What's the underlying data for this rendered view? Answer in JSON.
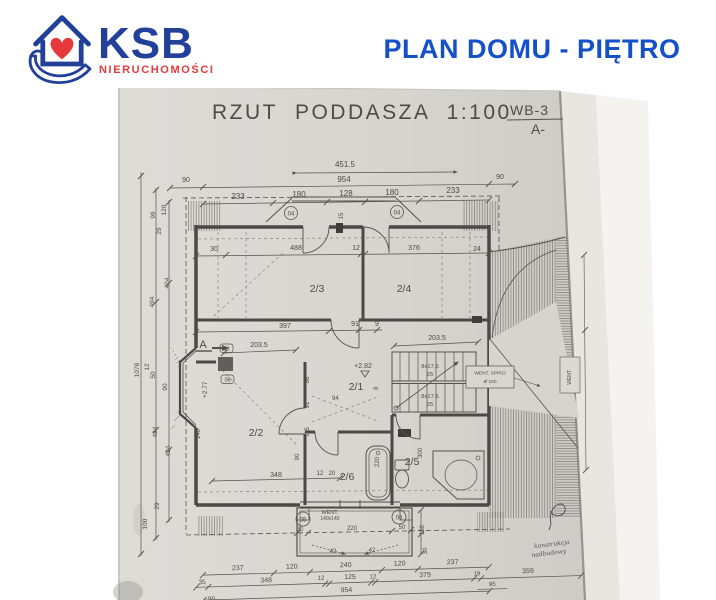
{
  "header": {
    "brand": "KSB",
    "brand_subtitle": "NIERUCHOMOŚCI",
    "page_title": "PLAN DOMU - PIĘTRO",
    "colors": {
      "brand_blue": "#21409a",
      "brand_red": "#e6393d",
      "title_blue": "#1450c8"
    }
  },
  "drawing": {
    "title": "RZUT PODDASZA 1:100",
    "sheet_code_line1": "WB-3",
    "sheet_code_line2": "A-",
    "paper_color": "#d8d6d1",
    "line_color": "#54524c",
    "rooms": {
      "hall": "2/1",
      "room_a": "2/2",
      "room_b": "2/3",
      "room_c": "2/4",
      "bath_a": "2/5",
      "bath_b": "2/6"
    },
    "levels": {
      "hall_level": "+2.82",
      "bay_level": "+2.77"
    },
    "stairs": {
      "riser_label": "8x17.6",
      "tread_label": "25"
    },
    "markers": {
      "dormer_left": "04",
      "dormer_right": "04",
      "bay_top": "08",
      "bay_bottom": "08",
      "balcony_left": "05",
      "balcony_right": "06",
      "section": "A"
    },
    "annotations": {
      "balcony_vent_1": "WENT.",
      "balcony_vent_2": "140x140",
      "roof_note_1": "WENT. SPIRO",
      "roof_note_2": "Ø 150",
      "wall_note": "WENT.",
      "hand_note_1": "konstrukcja",
      "hand_note_2": "nadbudowy"
    },
    "dims": {
      "top": [
        "451.5",
        "954",
        "90",
        "90",
        "233",
        "180",
        "128",
        "180",
        "233",
        "15"
      ],
      "rooms_top": [
        "30",
        "488",
        "12",
        "376",
        "24"
      ],
      "rooms_mid": [
        "397",
        "91",
        "9"
      ],
      "stair_depth": [
        "203.5",
        "203.5"
      ],
      "left": [
        "1078",
        "120",
        "99",
        "29",
        "424",
        "494",
        "12",
        "50",
        "90",
        "494",
        "424",
        "29",
        "100",
        "140"
      ],
      "room22": [
        "98",
        "91",
        "115",
        "90",
        "348",
        "12",
        "20"
      ],
      "baths": [
        "220",
        "300"
      ],
      "hall": [
        "8",
        "94"
      ],
      "balcony": [
        "30",
        "220",
        "50",
        "150",
        "30",
        "42",
        "42"
      ],
      "bottom1": [
        "237",
        "120",
        "240",
        "120",
        "237"
      ],
      "bottom2": [
        "35",
        "348",
        "12",
        "125",
        "12",
        "379",
        "19",
        "359"
      ],
      "bottom3": [
        "954",
        "95",
        "90"
      ]
    }
  }
}
